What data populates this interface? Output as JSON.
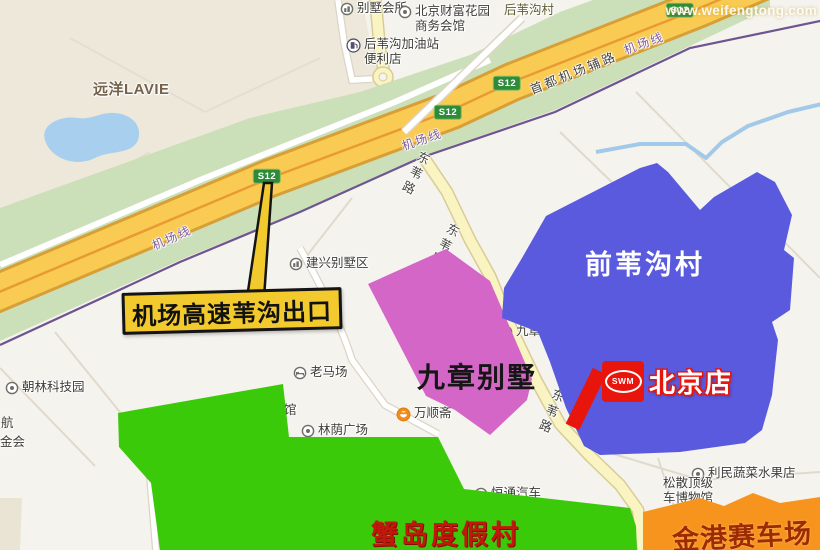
{
  "watermark": {
    "text": "www.weifengtong.com"
  },
  "map": {
    "badge": {
      "label": "S12",
      "positions": [
        {
          "x": 267,
          "y": 176
        },
        {
          "x": 448,
          "y": 112
        },
        {
          "x": 507,
          "y": 83
        },
        {
          "x": 680,
          "y": 10
        }
      ]
    },
    "labels": [
      {
        "name": "poi-villa-clubhouse",
        "icon": "building",
        "x": 340,
        "y": 1,
        "text": "别墅会所"
      },
      {
        "name": "poi-fortune-garden",
        "icon": "dot",
        "x": 398,
        "y": 4,
        "text": "北京财富花园",
        "text2": "商务会馆"
      },
      {
        "name": "poi-village-houweigou",
        "cls": "olive",
        "x": 504,
        "y": 3,
        "text": "后苇沟村"
      },
      {
        "name": "poi-gas-station",
        "icon": "gas",
        "x": 346,
        "y": 37,
        "text": "后苇沟加油站",
        "text2": "便利店"
      },
      {
        "name": "poi-yuanyang-lavie",
        "cls": "brown",
        "x": 93,
        "y": 81,
        "text": "远洋LAVIE"
      },
      {
        "name": "rail-label-west",
        "cls": "purple",
        "x": 150,
        "y": 240,
        "rot": -24,
        "text": "机场线"
      },
      {
        "name": "rail-label-mid",
        "cls": "purple",
        "x": 400,
        "y": 140,
        "rot": -19,
        "text": "机场线"
      },
      {
        "name": "rail-label-east",
        "cls": "purple",
        "x": 622,
        "y": 44,
        "rot": -20,
        "text": "机场线"
      },
      {
        "name": "road-label-airport-side-road",
        "cls": "road",
        "x": 528,
        "y": 84,
        "rot": -22,
        "text": "首都机场辅路"
      },
      {
        "name": "road-label-dongwei-north",
        "cls": "vroad",
        "x": 418,
        "y": 148,
        "rot": 26,
        "text": "东苇路"
      },
      {
        "name": "road-label-dongwei-mid",
        "cls": "vroad",
        "x": 448,
        "y": 220,
        "rot": 28,
        "text": "东苇路"
      },
      {
        "name": "road-label-dongwei-south",
        "cls": "vroad",
        "x": 552,
        "y": 386,
        "rot": 22,
        "text": "东苇路"
      },
      {
        "name": "poi-jianxing-villa-area",
        "icon": "building",
        "x": 289,
        "y": 256,
        "text": "建兴别墅区"
      },
      {
        "name": "poi-jiuzhang-villa-area",
        "icon": "building",
        "x": 499,
        "y": 324,
        "text": "九章别墅区"
      },
      {
        "name": "poi-chaolin-tech-park",
        "icon": "dot",
        "x": 5,
        "y": 380,
        "text": "朝林科技园"
      },
      {
        "name": "poi-edge-partial-hang",
        "x": 1,
        "y": 416,
        "text": "航"
      },
      {
        "name": "poi-edge-partial-jinhui",
        "x": 0,
        "y": 435,
        "text": "金会"
      },
      {
        "name": "poi-laomachang",
        "icon": "bed",
        "x": 293,
        "y": 365,
        "text": "老马场"
      },
      {
        "name": "poi-edge-partial-guan",
        "x": 284,
        "y": 403,
        "text": "馆"
      },
      {
        "name": "poi-linyin-plaza",
        "icon": "dot",
        "x": 301,
        "y": 423,
        "text": "林荫广场"
      },
      {
        "name": "poi-wanshunzhai",
        "icon": "food",
        "x": 396,
        "y": 406,
        "text": "万顺斋"
      },
      {
        "name": "poi-hengtong-driving-school",
        "icon": "dot",
        "x": 474,
        "y": 486,
        "text": "恒通汽车",
        "text2": "摩托车驾校"
      },
      {
        "name": "poi-limin-grocery",
        "icon": "dot",
        "x": 691,
        "y": 466,
        "text": "利民蔬菜水果店"
      },
      {
        "name": "poi-songsan-museum-partial",
        "x": 663,
        "y": 476,
        "text": "松散顶级",
        "text2": "车博物馆"
      }
    ]
  },
  "overlays": {
    "qianweigou_village": {
      "label": "前苇沟村",
      "fill": "#5A5ADF"
    },
    "jiuzhang_villas": {
      "label": "九章别墅",
      "fill": "#D466C8"
    },
    "xiedao_resort": {
      "label": "蟹岛度假村",
      "fill": "#3BCA0A",
      "text_color": "#C2180C"
    },
    "jingang_racetrack": {
      "label": "金港赛车场",
      "fill": "#F7941D",
      "text_color": "#9E2B00"
    },
    "store": {
      "label": "北京店",
      "logo_text": "SWM",
      "marker_color": "#E8150D"
    },
    "exit_callout": {
      "label": "机场高速苇沟出口",
      "fill": "#F2CA2E"
    }
  }
}
